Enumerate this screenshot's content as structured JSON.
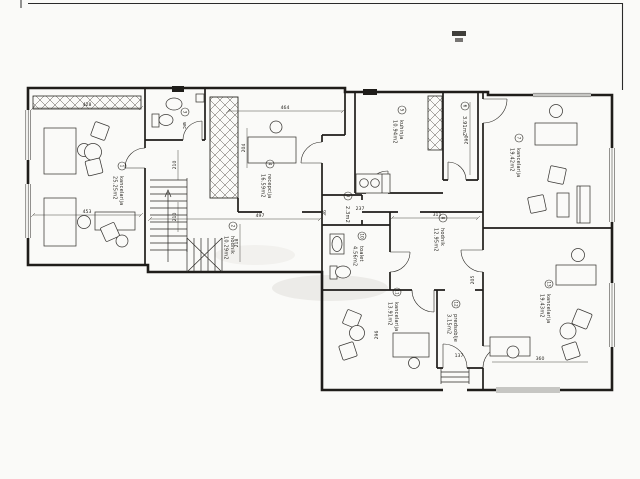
{
  "colors": {
    "paper": "#fafaf8",
    "ink": "#1f1d1a"
  },
  "rooms": [
    {
      "no": "1",
      "name": "kancelarija",
      "area": "25.25m2"
    },
    {
      "no": "2",
      "name": "hodnik",
      "area": "10.29m2"
    },
    {
      "no": "3",
      "name": "wc",
      "area": ""
    },
    {
      "no": "4",
      "name": "recepcija",
      "area": "16.59m2"
    },
    {
      "no": "5",
      "name": "kuhinja",
      "area": "10.94m2"
    },
    {
      "no": "6",
      "name": "",
      "area": "3.91m2"
    },
    {
      "no": "7",
      "name": "kancelarija",
      "area": "19.42m2"
    },
    {
      "no": "8",
      "name": "hodnik",
      "area": "12.95m2"
    },
    {
      "no": "9",
      "name": "",
      "area": "2.3m2"
    },
    {
      "no": "10",
      "name": "toalet",
      "area": "4.56m2"
    },
    {
      "no": "11",
      "name": "kancelarija",
      "area": "13.91m2"
    },
    {
      "no": "12",
      "name": "predsoblje",
      "area": "3.15m2"
    },
    {
      "no": "13",
      "name": "kancelarija",
      "area": "19.43m2"
    }
  ],
  "dimensions": [
    {
      "value": "428"
    },
    {
      "value": "464"
    },
    {
      "value": "453"
    },
    {
      "value": "497"
    },
    {
      "value": "204"
    },
    {
      "value": "210"
    },
    {
      "value": "210"
    },
    {
      "value": "218"
    },
    {
      "value": "237"
    },
    {
      "value": "36"
    },
    {
      "value": "311"
    },
    {
      "value": "290"
    },
    {
      "value": "205"
    },
    {
      "value": "296"
    },
    {
      "value": "360"
    },
    {
      "value": "137"
    }
  ]
}
